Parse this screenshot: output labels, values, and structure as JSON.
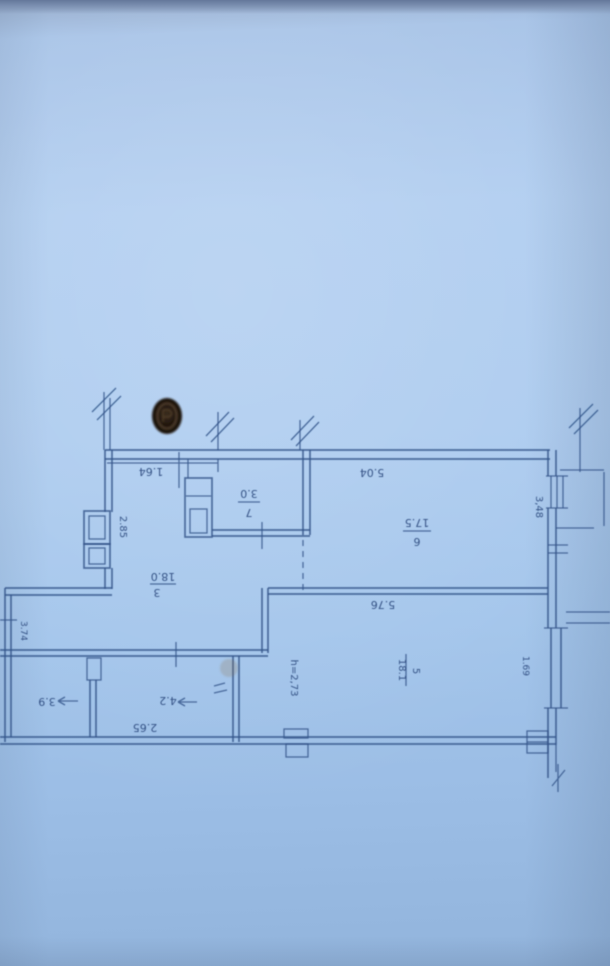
{
  "colors": {
    "paper": "#a9c7ea",
    "ink": "#35548a",
    "stamp": "#20150e",
    "stain": "#8a6a3f"
  },
  "plan": {
    "dimensions": {
      "top_left": "1.64",
      "top_main": "5.04",
      "shaft_left": "2.85",
      "right_upper": "3,48",
      "room5_top": "5.76",
      "room5_right": "1.69",
      "bottom_left": "2.65",
      "left_lower": "3.74"
    },
    "notes": {
      "ceiling_height": "h=2,73"
    },
    "rooms": [
      {
        "number": "7",
        "area": "3.0"
      },
      {
        "number": "6",
        "area": "17.5"
      },
      {
        "number": "3",
        "area": "18.0"
      },
      {
        "number": "5",
        "area": "18.1"
      },
      {
        "area": "4.2"
      },
      {
        "area": "3.9"
      }
    ]
  }
}
